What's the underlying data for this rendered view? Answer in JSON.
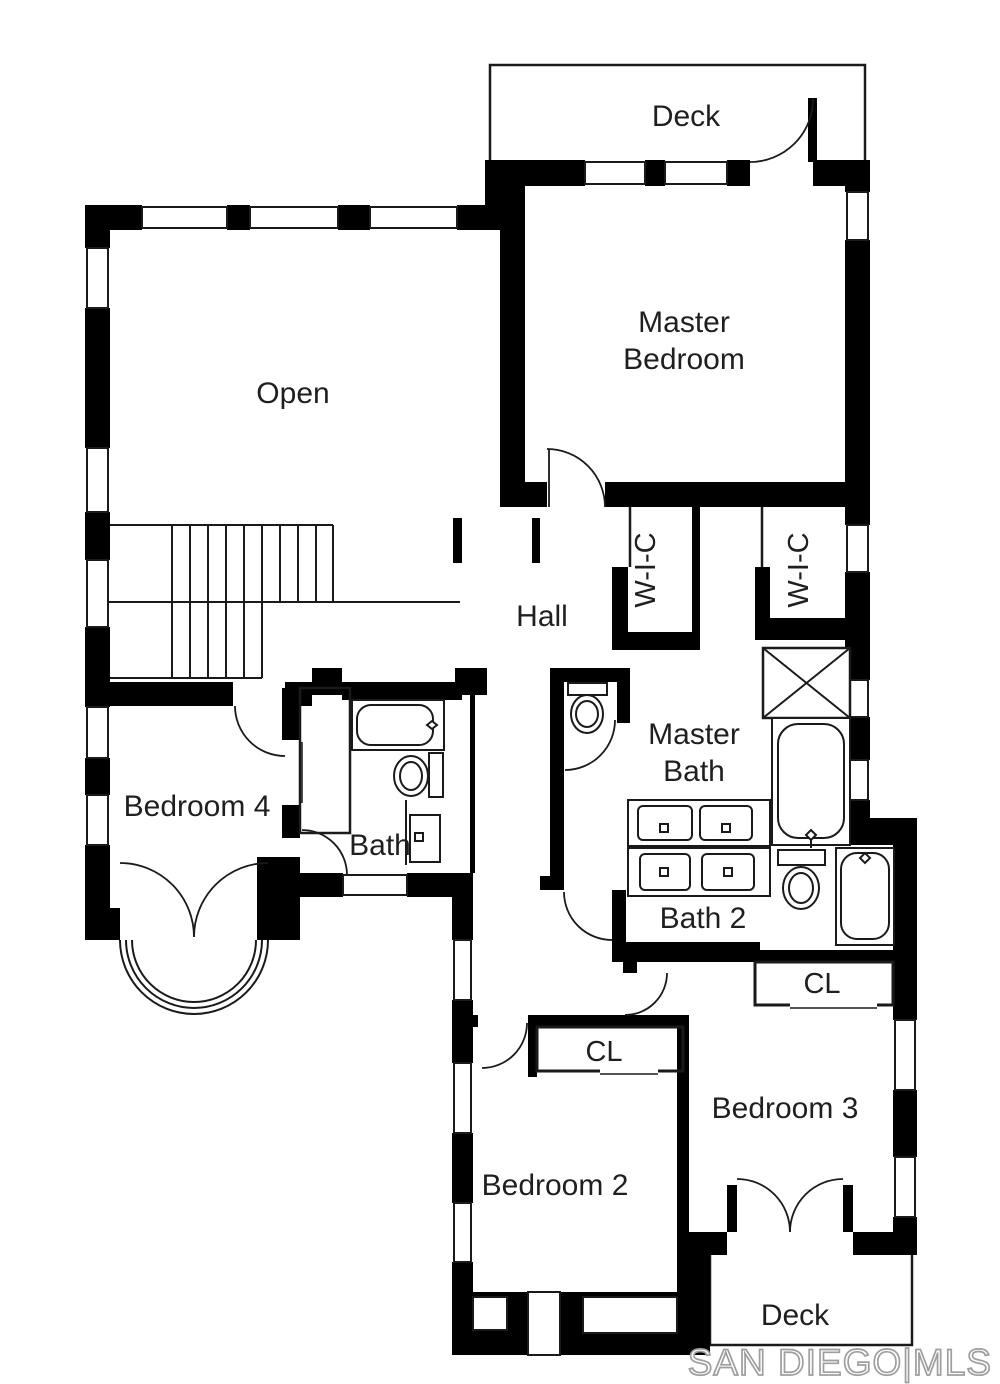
{
  "plan": {
    "title": "Upper floor plan",
    "labels": {
      "deck_top": "Deck",
      "master_bedroom_line1": "Master",
      "master_bedroom_line2": "Bedroom",
      "open": "Open",
      "hall": "Hall",
      "wic_left": "W-I-C",
      "wic_right": "W-I-C",
      "master_bath_line1": "Master",
      "master_bath_line2": "Bath",
      "bedroom4": "Bedroom 4",
      "bath": "Bath",
      "bath2": "Bath 2",
      "cl_bedroom2": "CL",
      "cl_bedroom3": "CL",
      "bedroom2": "Bedroom 2",
      "bedroom3": "Bedroom 3",
      "deck_bottom": "Deck"
    },
    "watermark": "SAN DIEGO|MLS",
    "colors": {
      "wall": "#000000",
      "line": "#1a1a1a",
      "text": "#1f1f1f",
      "watermark_outline": "#9e9e9e",
      "background": "#ffffff"
    }
  }
}
